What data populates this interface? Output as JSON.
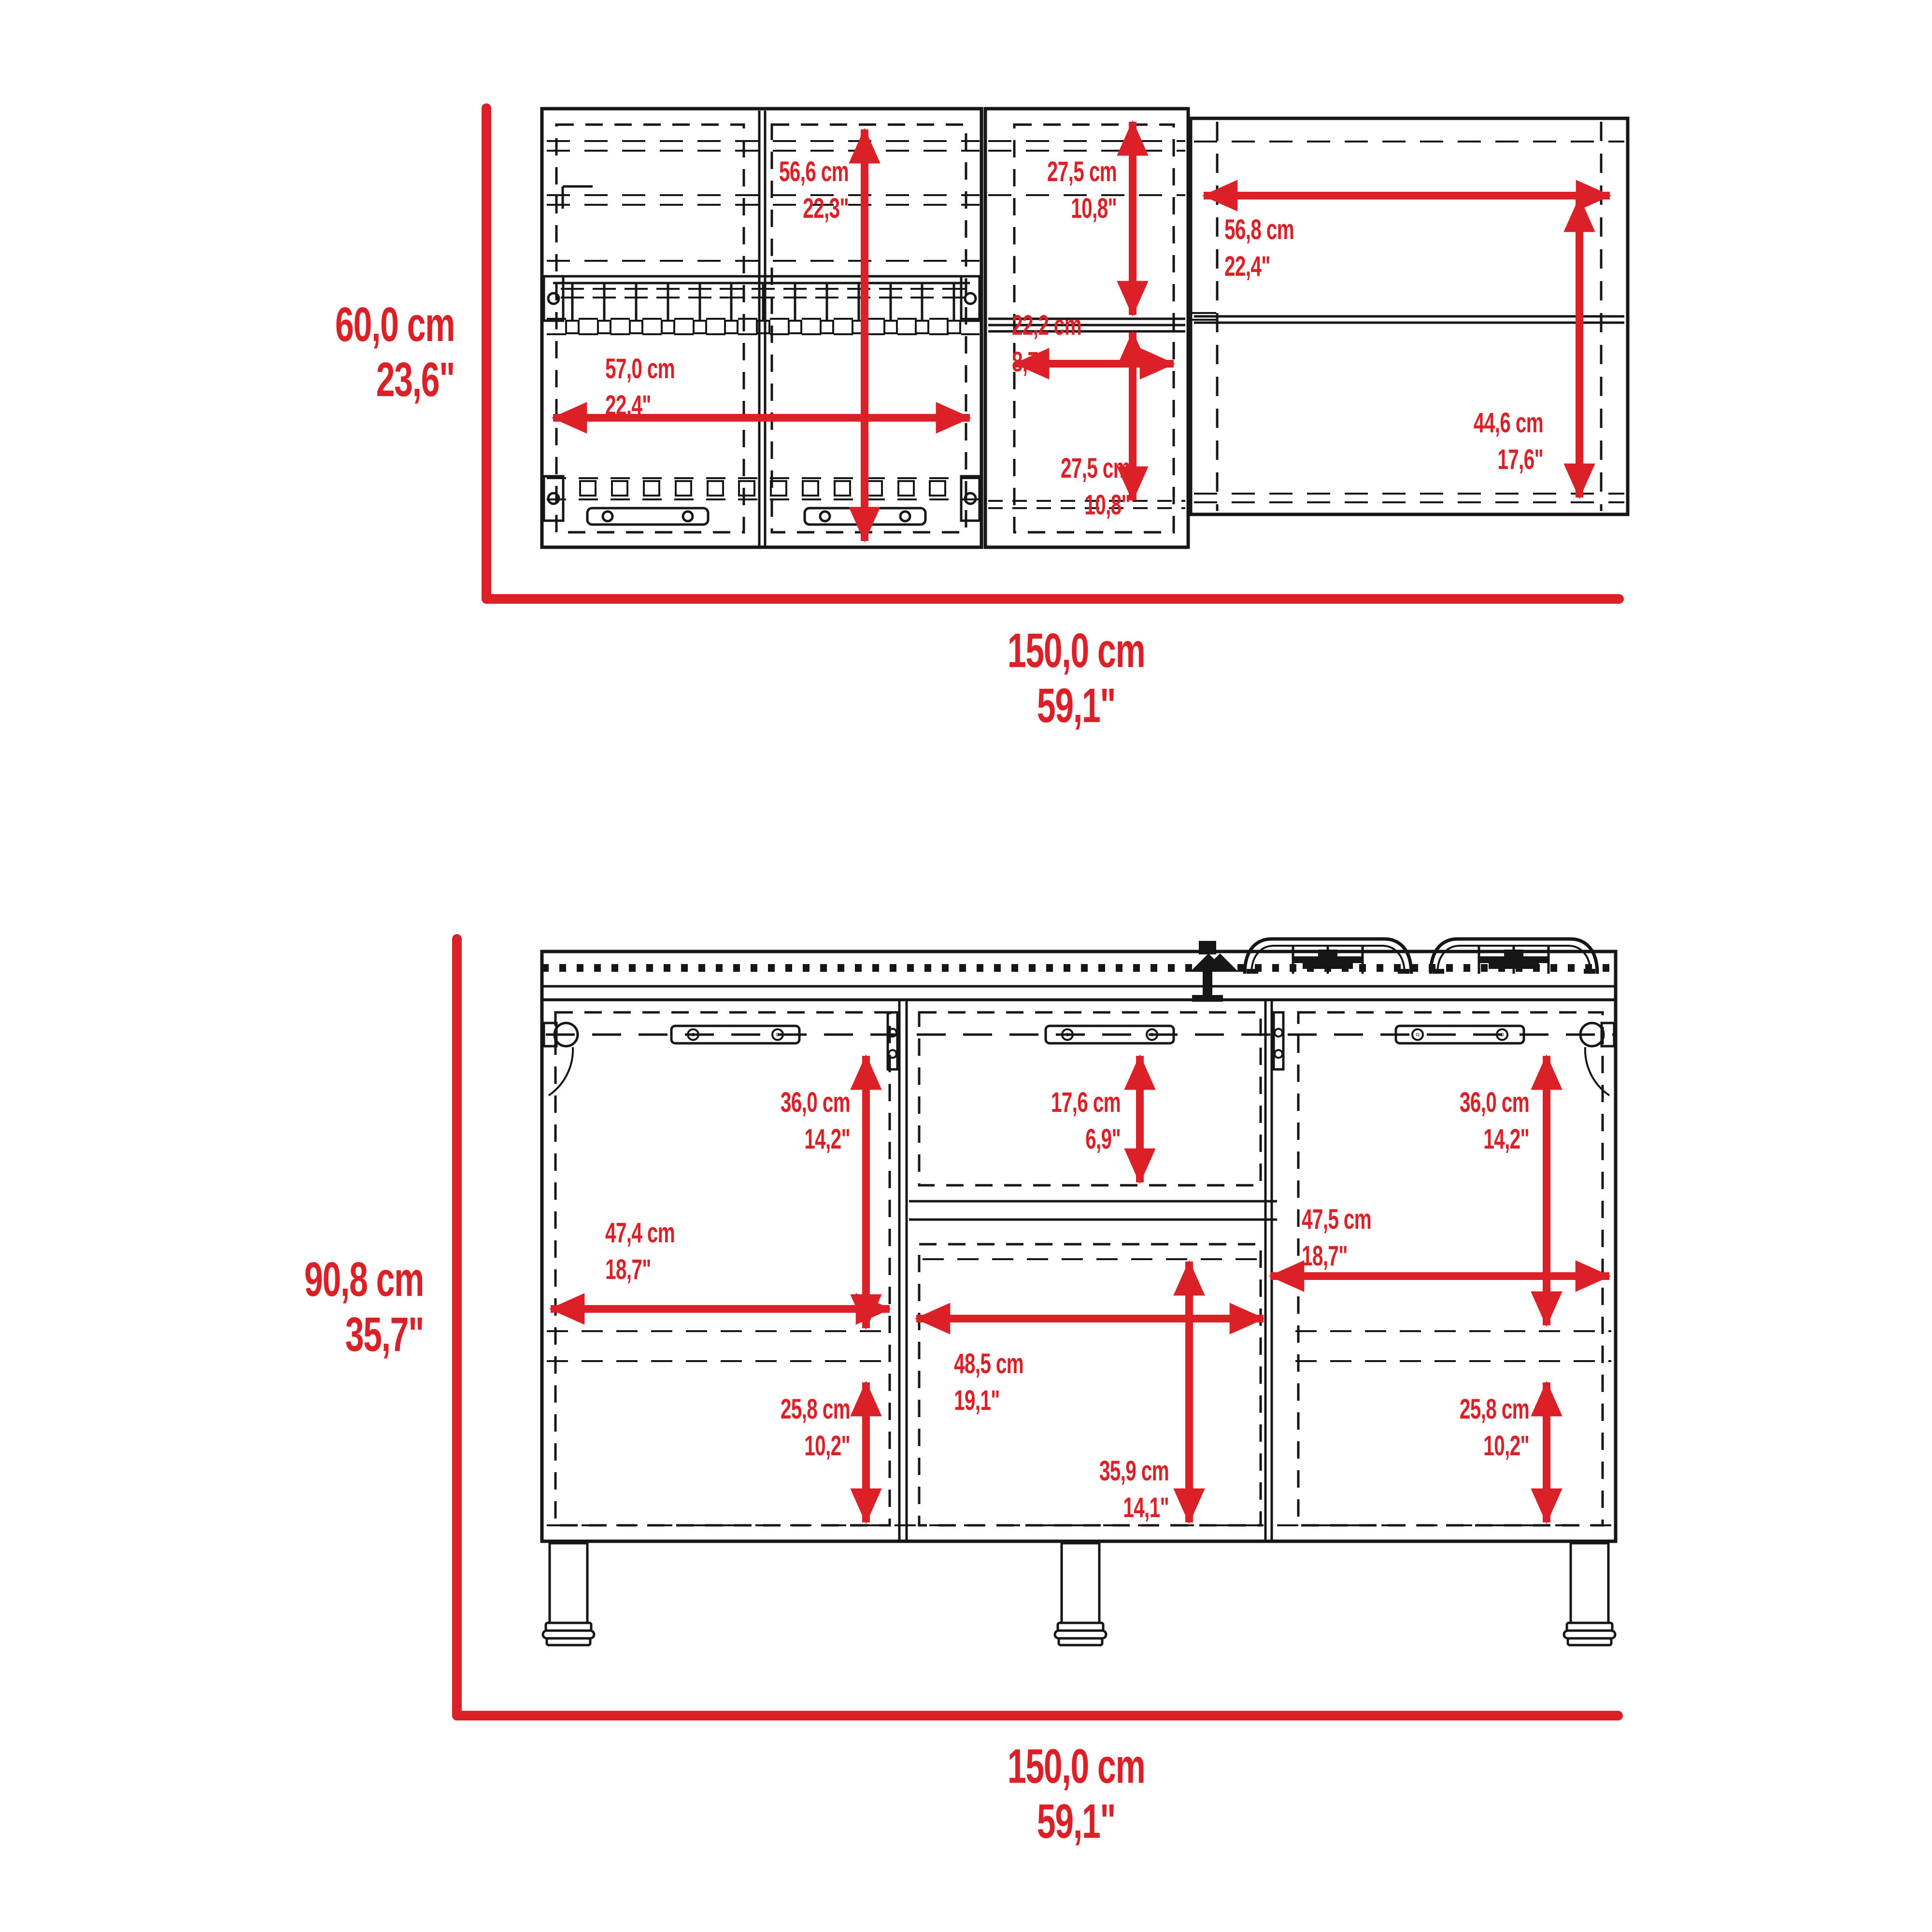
{
  "sheet": {
    "type": "furniture dimension drawing",
    "views": [
      "wall cabinet front view",
      "base cabinet with cooktop front view"
    ]
  },
  "colors": {
    "dimension_red": "#DB2127",
    "line_black": "#161616",
    "background": "#ffffff"
  },
  "wall_cabinet": {
    "overall_height": {
      "cm": "60,0 cm",
      "in": "23,6\""
    },
    "overall_width": {
      "cm": "150,0 cm",
      "in": "59,1\""
    },
    "left_section_height": {
      "cm": "56,6 cm",
      "in": "22,3\""
    },
    "left_section_width": {
      "cm": "57,0 cm",
      "in": "22,4\""
    },
    "middle_top_height": {
      "cm": "27,5 cm",
      "in": "10,8\""
    },
    "middle_width": {
      "cm": "22,2 cm",
      "in": "8,7\""
    },
    "middle_bottom_height": {
      "cm": "27,5 cm",
      "in": "10,8\""
    },
    "right_section_width": {
      "cm": "56,8 cm",
      "in": "22,4\""
    },
    "right_section_height": {
      "cm": "44,6 cm",
      "in": "17,6\""
    }
  },
  "base_cabinet": {
    "overall_height": {
      "cm": "90,8 cm",
      "in": "35,7\""
    },
    "overall_width": {
      "cm": "150,0 cm",
      "in": "59,1\""
    },
    "left_door_height": {
      "cm": "36,0 cm",
      "in": "14,2\""
    },
    "left_door_width": {
      "cm": "47,4 cm",
      "in": "18,7\""
    },
    "left_lower_height": {
      "cm": "25,8 cm",
      "in": "10,2\""
    },
    "drawer_height": {
      "cm": "17,6 cm",
      "in": "6,9\""
    },
    "middle_width": {
      "cm": "48,5 cm",
      "in": "19,1\""
    },
    "middle_lower_height": {
      "cm": "35,9 cm",
      "in": "14,1\""
    },
    "right_door_height": {
      "cm": "36,0 cm",
      "in": "14,2\""
    },
    "right_door_width": {
      "cm": "47,5 cm",
      "in": "18,7\""
    },
    "right_lower_height": {
      "cm": "25,8 cm",
      "in": "10,2\""
    }
  }
}
